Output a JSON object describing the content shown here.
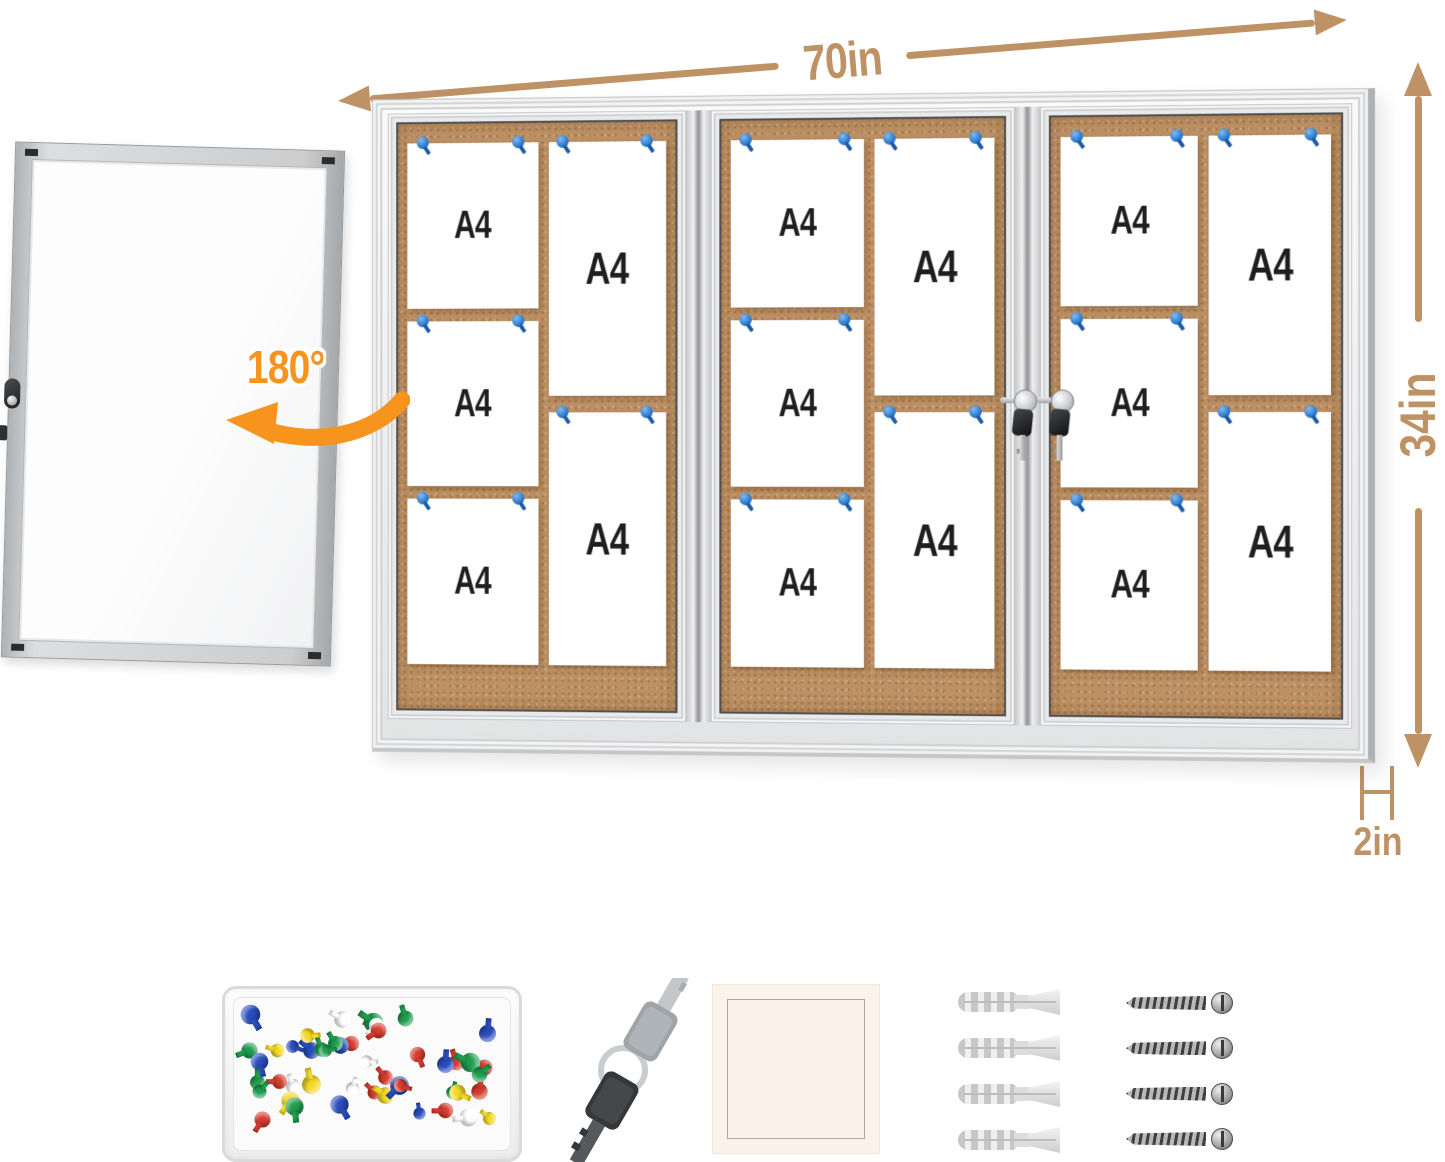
{
  "annotations": {
    "width": "70in",
    "height": "34in",
    "depth": "2in",
    "door_swing": "180°"
  },
  "board": {
    "sections": [
      {
        "papers_left": [
          "A4",
          "A4",
          "A4"
        ],
        "papers_right": [
          "A4",
          "A4"
        ]
      },
      {
        "papers_left": [
          "A4",
          "A4",
          "A4"
        ],
        "papers_right": [
          "A4",
          "A4"
        ]
      },
      {
        "papers_left": [
          "A4",
          "A4",
          "A4"
        ],
        "papers_right": [
          "A4",
          "A4"
        ]
      }
    ],
    "lock_count": 2,
    "pin_per_paper": 2
  },
  "colors": {
    "dimension_tan": "#BE9265",
    "swing_orange": "#F7941E",
    "cork": "#BE9164",
    "pin_blue": "#2E7FD0"
  },
  "accessories": {
    "pushpin_colors": [
      "#D63B2F",
      "#2A4DBF",
      "#1F9E4F",
      "#F4D925",
      "#FFFFFF"
    ],
    "pushpin_count": 48,
    "key_count": 2,
    "wall_anchor_count": 4,
    "screw_count": 4
  }
}
